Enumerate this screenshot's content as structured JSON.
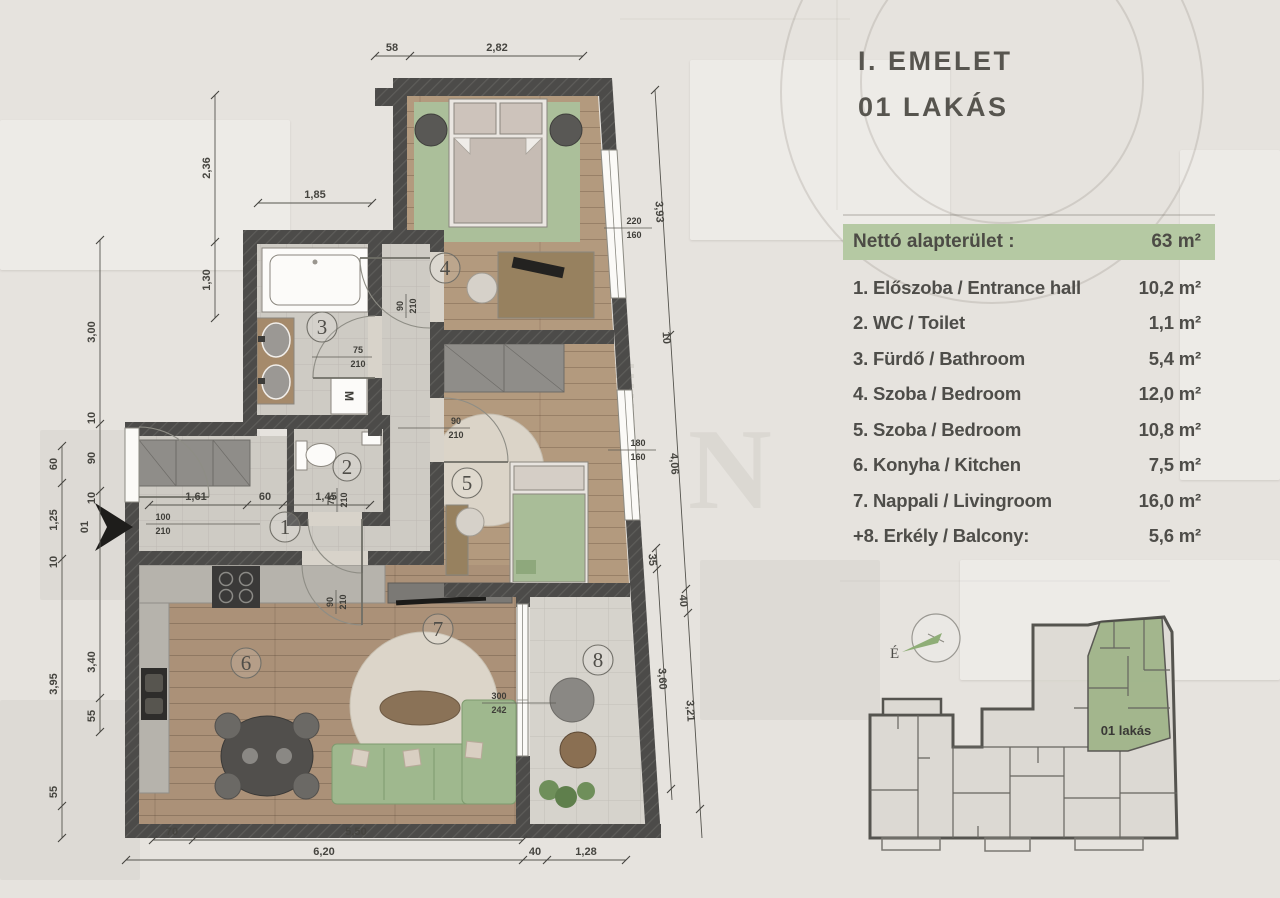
{
  "title": {
    "line1": "I. EMELET",
    "line2": "01 LAKÁS"
  },
  "legend": {
    "header": {
      "label": "Nettó alapterület :",
      "value": "63 m²"
    },
    "rows": [
      {
        "label": "1. Előszoba / Entrance hall",
        "value": "10,2 m²"
      },
      {
        "label": "2. WC / Toilet",
        "value": "1,1 m²"
      },
      {
        "label": "3. Fürdő / Bathroom",
        "value": "5,4 m²"
      },
      {
        "label": "4. Szoba / Bedroom",
        "value": "12,0 m²"
      },
      {
        "label": "5. Szoba / Bedroom",
        "value": "10,8 m²"
      },
      {
        "label": "6. Konyha / Kitchen",
        "value": "7,5 m²"
      },
      {
        "label": "7. Nappali / Livingroom",
        "value": "16,0 m²"
      },
      {
        "label": "+8. Erkély / Balcony:",
        "value": "5,6 m²"
      }
    ]
  },
  "plan": {
    "rooms": [
      "1",
      "2",
      "3",
      "4",
      "5",
      "6",
      "7",
      "8"
    ],
    "entrance_label": "01",
    "washer_label": "M",
    "dims": {
      "top_58": "58",
      "top_282": "2,82",
      "l_300": "3,00",
      "l_60": "60",
      "l_125": "1,25",
      "l_10": "10",
      "l_395": "3,95",
      "l_55": "55",
      "l_236": "2,36",
      "l_130": "1,30",
      "e_10a": "10",
      "e_90": "90",
      "e_10b": "10",
      "e_340": "3,40",
      "e_55": "55",
      "bath_185": "1,85",
      "hall_161": "1,61",
      "hall_60": "60",
      "hall_145": "1,45",
      "b_70": "70",
      "b_550": "5,50",
      "b_620": "6,20",
      "b_40": "40",
      "b_128": "1,28",
      "r_393": "3,93",
      "r_10": "10",
      "r_406": "4,06",
      "r_35": "35",
      "r_360": "3,60",
      "r_40": "40",
      "r_321": "3,21"
    },
    "doors": {
      "entrance_w": "100",
      "entrance_h": "210",
      "bath_w": "75",
      "bath_h": "210",
      "wc_w": "75",
      "wc_h": "210",
      "bed4_w": "90",
      "bed4_h": "210",
      "bed5_w": "90",
      "bed5_h": "210",
      "living_w": "90",
      "living_h": "210",
      "balcony_w": "300",
      "balcony_h": "242",
      "win_top_w": "220",
      "win_top_h": "160",
      "win_mid_w": "180",
      "win_mid_h": "160"
    }
  },
  "keyplan": {
    "apartment_label": "01 lakás",
    "compass_label": "É"
  },
  "watermark": {
    "letter1": "G",
    "letter2": "N"
  },
  "colors": {
    "accent_green": "#b5c9a3",
    "keyplan_green": "#9db386",
    "wall": "#4c4b49",
    "wood_floor": "#b0977c",
    "tile_floor": "#cdcac3",
    "sofa_green": "#9fb88e",
    "rug_green": "#abbf9a",
    "text": "#4e4d49"
  }
}
